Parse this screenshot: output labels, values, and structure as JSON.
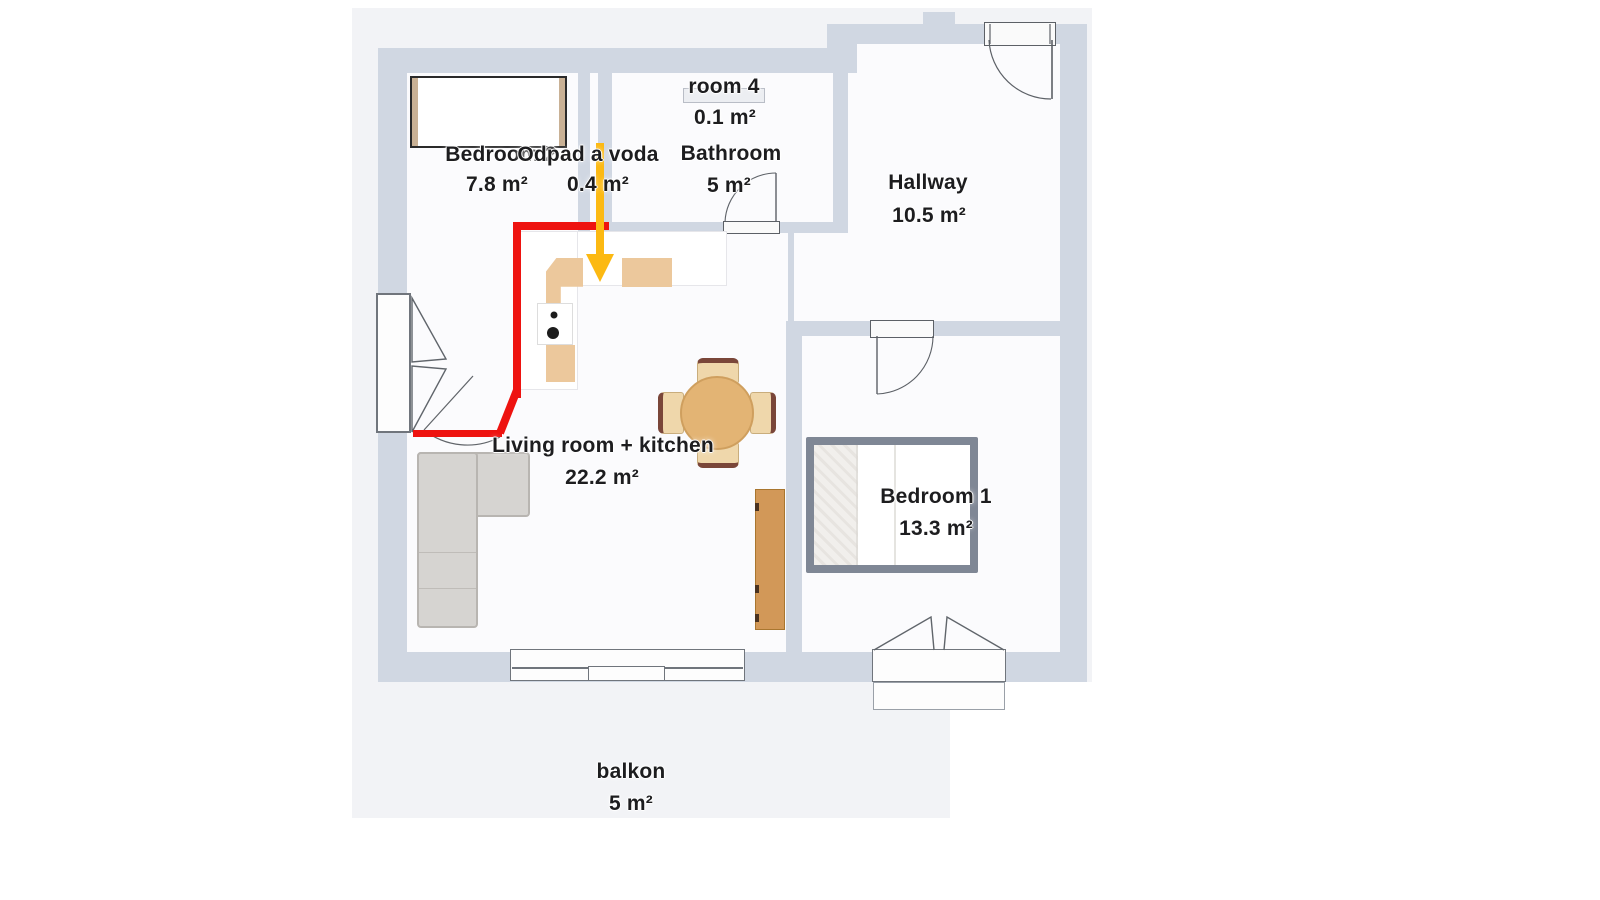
{
  "plan": {
    "rooms": [
      {
        "label": "Bedroom 2",
        "area": "7.8 m²"
      },
      {
        "label": "Odpad a voda",
        "area": "0.4 m²"
      },
      {
        "label": "room 4",
        "area": "0.1 m²"
      },
      {
        "label": "Bathroom",
        "area": "5 m²"
      },
      {
        "label": "Hallway",
        "area": "10.5 m²"
      },
      {
        "label": "Living room + kitchen",
        "area": "22.2 m²"
      },
      {
        "label": "Bedroom 1",
        "area": "13.3 m²"
      },
      {
        "label": "balkon",
        "area": "5 m²"
      }
    ],
    "colors": {
      "canvas": "#f2f3f6",
      "floor": "#fbfbfd",
      "wall": "#d0d7e2",
      "annotation_red": "#ee1310",
      "annotation_yellow": "#fcb912"
    }
  }
}
